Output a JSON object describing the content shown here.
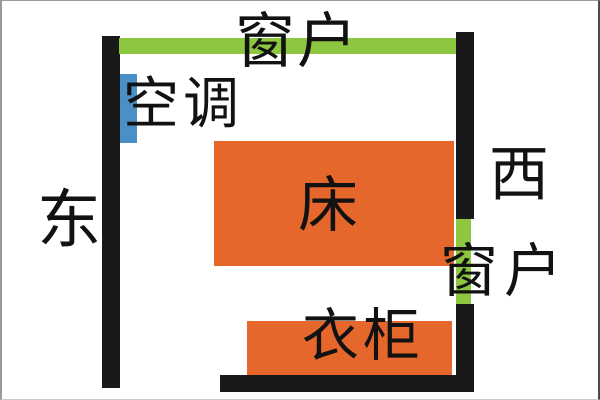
{
  "diagram": {
    "type": "room-floor-plan",
    "labels": {
      "window_top": "窗户",
      "air_conditioner": "空调",
      "east": "东",
      "west": "西",
      "bed": "床",
      "window_right": "窗户",
      "wardrobe": "衣柜"
    },
    "colors": {
      "wall": "#191919",
      "window": "#8dc63f",
      "furniture": "#e6672b",
      "air_conditioner": "#4a8fc5",
      "text": "#121212",
      "background": "#ffffff",
      "frame": "#9a9a9a"
    }
  }
}
